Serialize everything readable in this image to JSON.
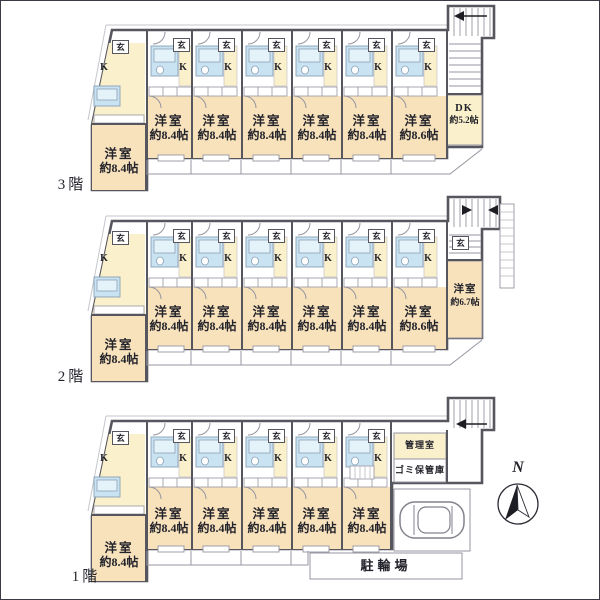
{
  "colors": {
    "wall": "#56565f",
    "room_fill": "#f8e2bc",
    "kitchen_fill": "#faf0cb",
    "bath_fill": "#c9e3f2",
    "tub_fill": "#e4f2fa",
    "thin_line": "#9595a0"
  },
  "labels": {
    "entrance": "玄",
    "kitchen": "K",
    "north": "N"
  },
  "floors": [
    {
      "name": "3階",
      "corner_unit": {
        "type": "洋室",
        "size": "約8.4帖"
      },
      "units": [
        {
          "type": "洋室",
          "size": "約8.4帖"
        },
        {
          "type": "洋室",
          "size": "約8.4帖"
        },
        {
          "type": "洋室",
          "size": "約8.4帖"
        },
        {
          "type": "洋室",
          "size": "約8.4帖"
        },
        {
          "type": "洋室",
          "size": "約8.4帖"
        },
        {
          "type": "洋室",
          "size": "約8.6帖"
        }
      ],
      "dk_unit": {
        "type": "DK",
        "size": "約5.2帖"
      }
    },
    {
      "name": "2階",
      "corner_unit": {
        "type": "洋室",
        "size": "約8.4帖"
      },
      "units": [
        {
          "type": "洋室",
          "size": "約8.4帖"
        },
        {
          "type": "洋室",
          "size": "約8.4帖"
        },
        {
          "type": "洋室",
          "size": "約8.4帖"
        },
        {
          "type": "洋室",
          "size": "約8.4帖"
        },
        {
          "type": "洋室",
          "size": "約8.4帖"
        },
        {
          "type": "洋室",
          "size": "約8.6帖"
        }
      ],
      "right_unit": {
        "type": "洋室",
        "size": "約6.7帖"
      }
    },
    {
      "name": "1階",
      "corner_unit": {
        "type": "洋室",
        "size": "約8.4帖"
      },
      "units": [
        {
          "type": "洋室",
          "size": "約8.4帖"
        },
        {
          "type": "洋室",
          "size": "約8.4帖"
        },
        {
          "type": "洋室",
          "size": "約8.4帖"
        },
        {
          "type": "洋室",
          "size": "約8.4帖"
        },
        {
          "type": "洋室",
          "size": "約8.4帖"
        }
      ],
      "facilities": {
        "manager_room": "管理室",
        "garbage_storage": "ゴミ保管庫",
        "bicycle_parking": "駐輪場"
      }
    }
  ]
}
